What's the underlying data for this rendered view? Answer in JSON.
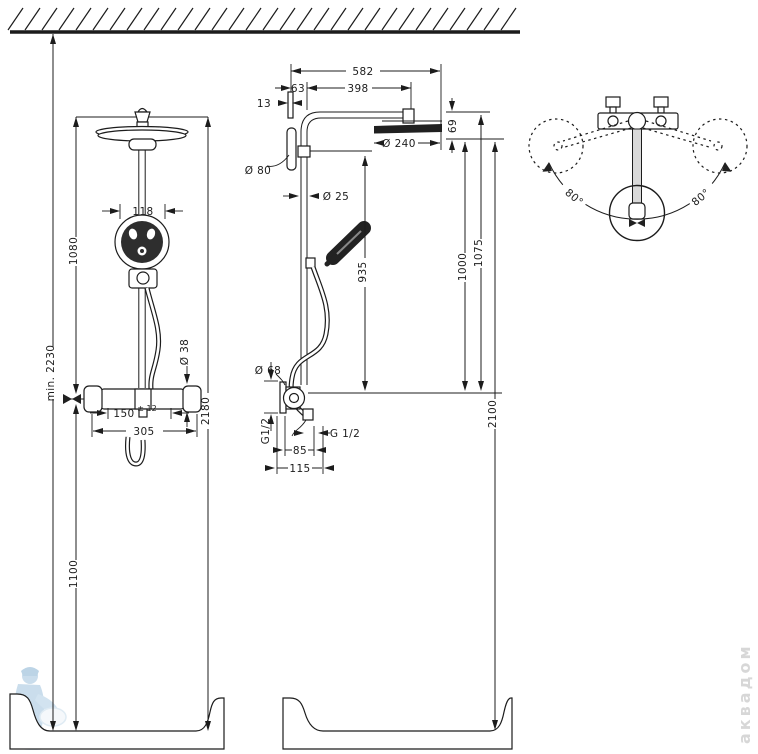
{
  "dims_left": {
    "min_total": "min. 2230",
    "upper": "1080",
    "lower": "1100",
    "total": "2180",
    "hand_width": "118",
    "knob_dia": "Ø 38",
    "span": "150",
    "span_tol": "± 12",
    "width": "305"
  },
  "dims_middle": {
    "overall": "582",
    "arm": "398",
    "offset": "63",
    "plate": "13",
    "wall_dia": "Ø 80",
    "pipe_dia": "Ø 25",
    "head_dia": "Ø 240",
    "head_h": "69",
    "bar": "935",
    "to_head_bottom": "1000",
    "to_arm": "1075",
    "total": "2100",
    "valve_dia": "Ø 68",
    "thread_v": "G1/2",
    "thread_h": "G 1/2",
    "conn_a": "85",
    "conn_b": "115"
  },
  "dims_right": {
    "left_angle": "80°",
    "right_angle": "80°"
  },
  "watermark": {
    "shop": "аквадом"
  }
}
